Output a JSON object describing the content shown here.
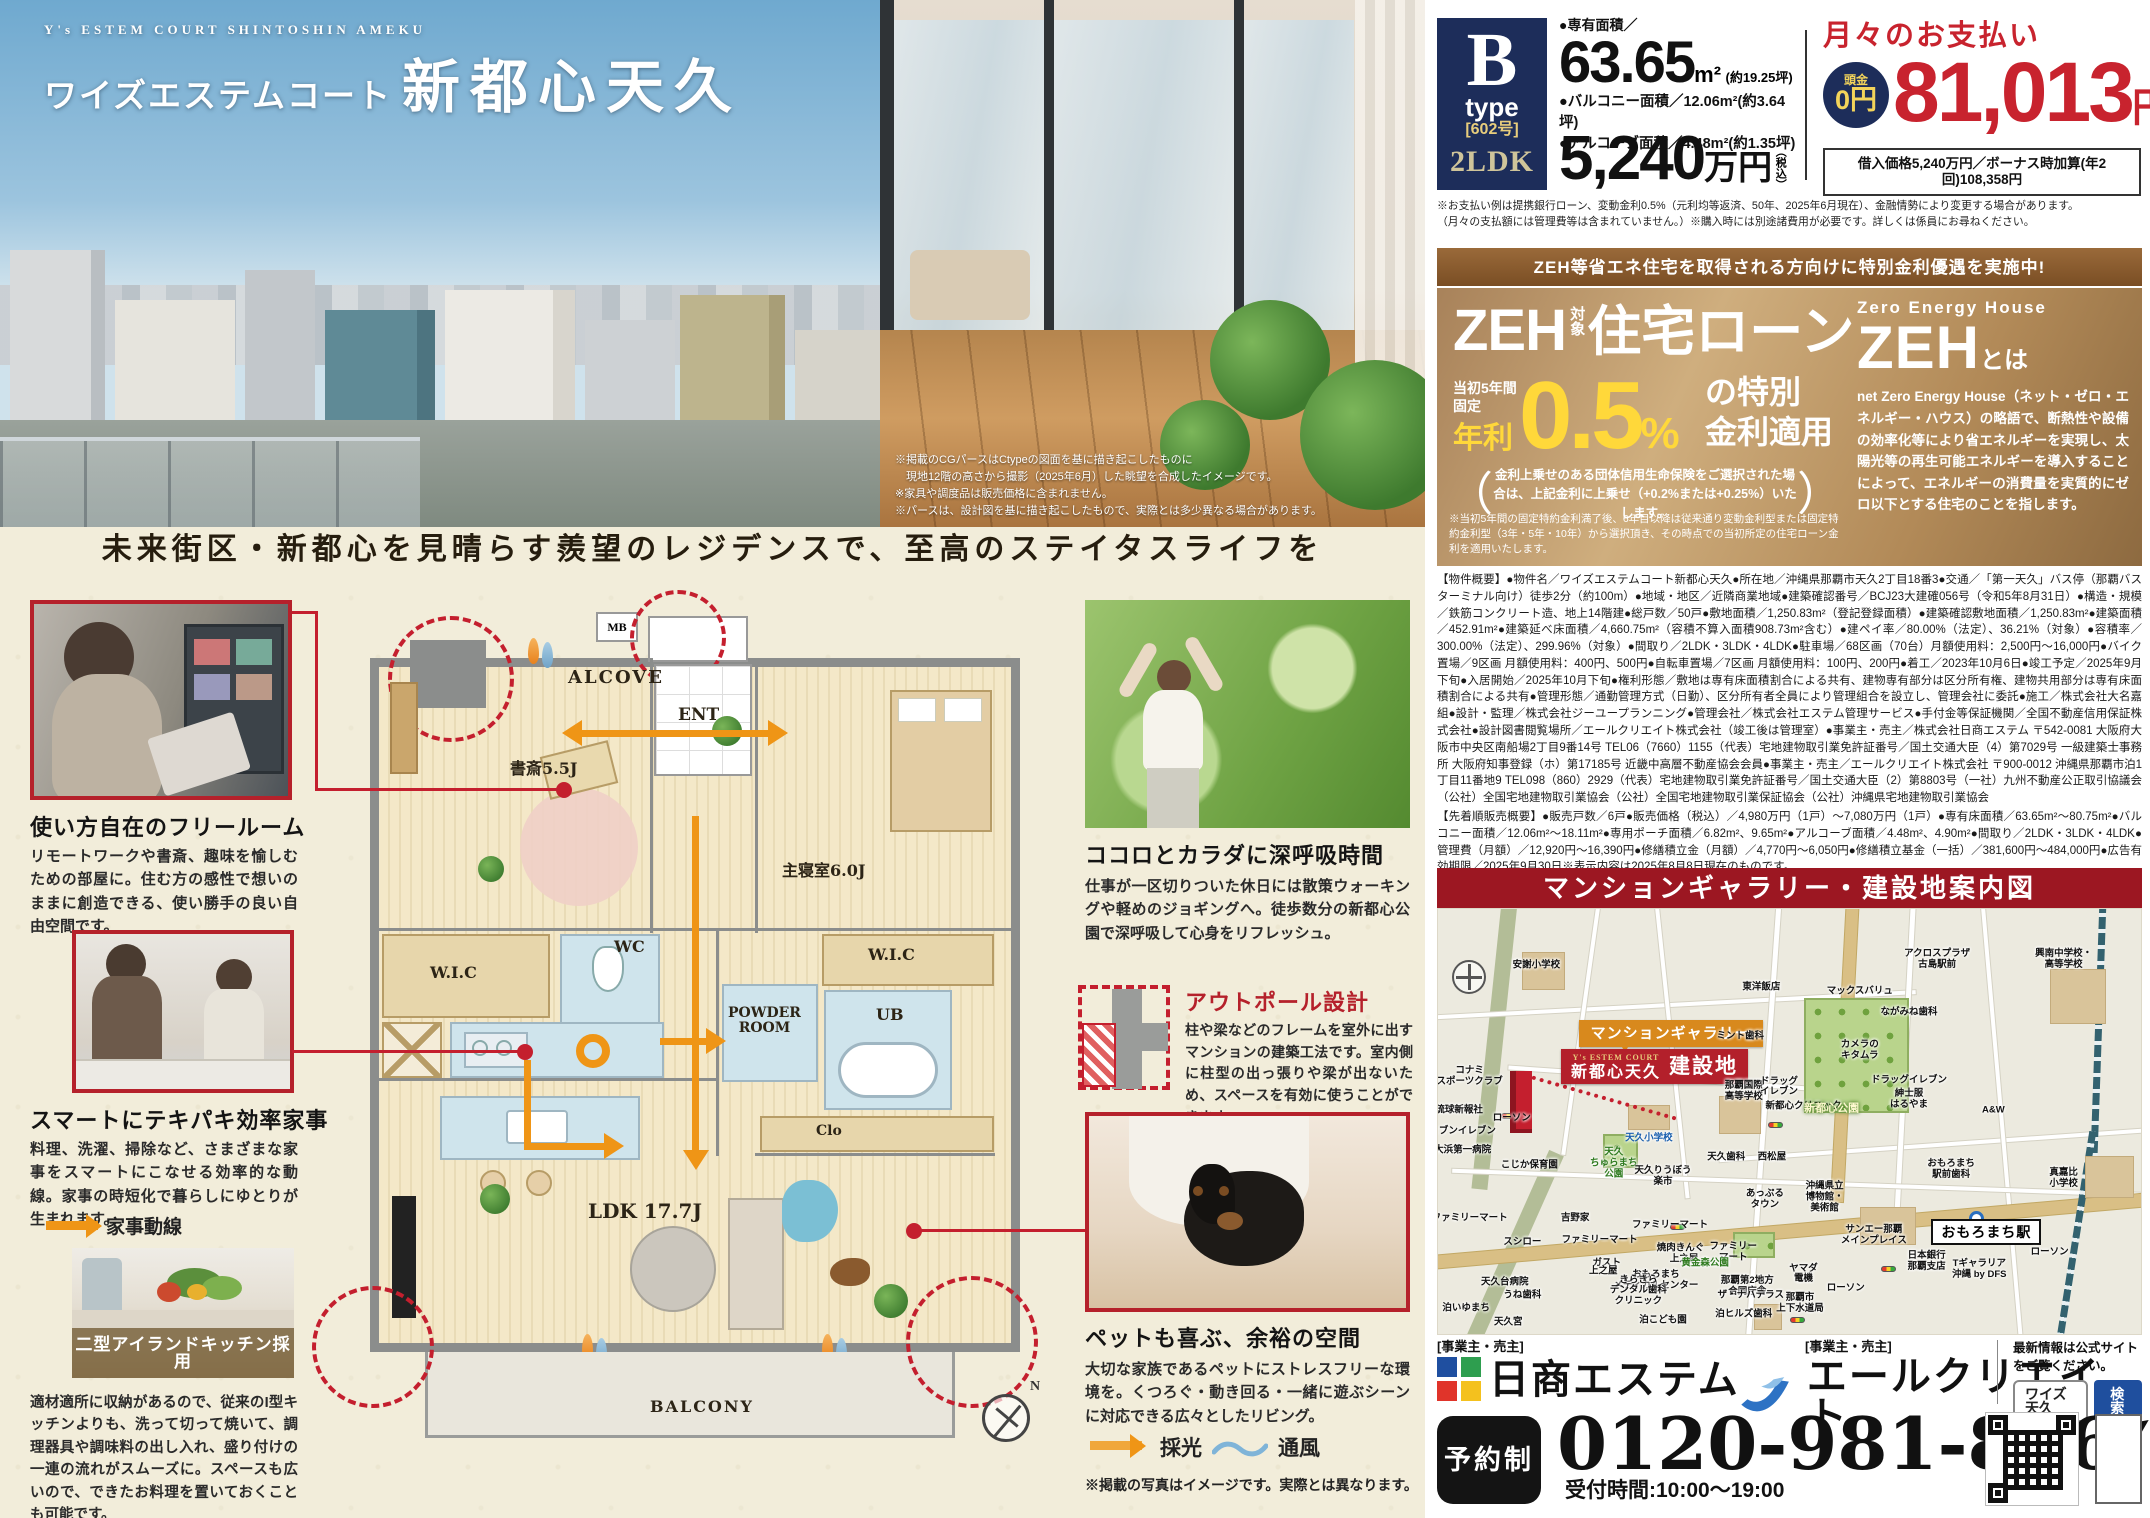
{
  "hero": {
    "en_title": "Y's ESTEM COURT SHINTOSHIN AMEKU",
    "brand": "ワイズエステムコート",
    "name": "新都心天久",
    "notes": "※掲載のCGパースはCtypeの図面を基に描き起こしたものに\n　現地12階の高さから撮影（2025年6月）した眺望を合成したイメージです。\n※家具や調度品は販売価格に含まれません。\n※パースは、設計図を基に描き起こしたもので、実際とは多少異なる場合があります。"
  },
  "tagline": "未来街区・新都心を見晴らす羨望のレジデンスで、至高のステイタスライフを",
  "features_left": [
    {
      "title": "使い方自在のフリールーム",
      "body": "リモートワークや書斎、趣味を愉しむための部屋に。住む方の感性で想いのままに創造できる、使い勝手の良い自由空間です。"
    },
    {
      "title": "スマートにテキパキ効率家事",
      "body": "料理、洗濯、掃除など、さまざまな家事をスマートにこなせる効率的な動線。家事の時短化で暮らしにゆとりが生まれます。",
      "legend": "家事動線"
    },
    {
      "title": "二型アイランドキッチン採用",
      "body": "適材適所に収納があるので、従来のI型キッチンよりも、洗って切って焼いて、調理器具や調味料の出し入れ、盛り付けの一連の流れがスムーズに。スペースも広いので、できたお料理を置いておくことも可能です。"
    }
  ],
  "features_right": [
    {
      "title": "ココロとカラダに深呼吸時間",
      "body": "仕事が一区切りついた休日には散策ウォーキングや軽めのジョギングへ。徒歩数分の新都心公園で深呼吸して心身をリフレッシュ。"
    },
    {
      "title": "アウトポール設計",
      "body": "柱や梁などのフレームを室外に出すマンションの建築工法です。室内側に柱型の出っ張りや梁が出ないため、スペースを有効に使うことができます。"
    },
    {
      "title": "ペットも喜ぶ、余裕の空間",
      "body": "大切な家族であるペットにストレスフリーな環境を。くつろぐ・動き回る・一緒に遊ぶシーンに対応できる広々としたリビング。"
    }
  ],
  "legend": {
    "saiko": "採光",
    "tsufu": "通風",
    "photo_note": "※掲載の写真はイメージです。実際とは異なります。"
  },
  "floorplan": {
    "alcove": "ALCOVE",
    "mb": "MB",
    "ent": "ENT",
    "study": "書斎5.5J",
    "bedroom": "主寝室6.0J",
    "wic1": "W.I.C",
    "wic2": "W.I.C",
    "wc": "WC",
    "powder": "POWDER\nROOM",
    "ub": "UB",
    "clo": "Clo",
    "ldk": "LDK 17.7J",
    "balcony": "BALCONY",
    "north": "N"
  },
  "price_panel": {
    "type_letter": "B",
    "type_word": "type",
    "unit_no": "[602号]",
    "layout": "2LDK",
    "area_label": "●専有面積／",
    "area_value": "63.65",
    "area_unit": "m²",
    "area_tsubo": "(約19.25坪)",
    "balcony_line": "●バルコニー面積／12.06m²(約3.64坪)",
    "alcove_line": "●アルコーブ面積／4.48m²(約1.35坪)",
    "price_value": "5,240",
    "price_unit": "万円",
    "price_tax": "（税込）",
    "monthly_title": "月々のお支払い",
    "down_label": "頭金",
    "down_value": "0円",
    "monthly_value": "81,013",
    "monthly_unit": "円",
    "loan_note": "借入価格5,240万円／ボーナス時加算(年2回)108,358円",
    "fine_print": "※お支払い例は提携銀行ローン、変動金利0.5%（元利均等返済、50年、2025年6月現在）、金融情勢により変更する場合があります。\n（月々の支払額には管理費等は含まれていません。）※購入時には別途諸費用が必要です。詳しくは係員にお尋ねください。"
  },
  "zeh": {
    "banner": "ZEH等省エネ住宅を取得される方向けに特別金利優遇を実施中!",
    "t_zeh": "ZEH",
    "t_taisho": "対象",
    "t_rest": "住宅ローン",
    "fixed": "当初5年間固定",
    "nenri": "年利",
    "rate": "0.5",
    "percent": "%",
    "rate_rest": "の特別\n金利適用",
    "paren_open": "（",
    "paren_close": "）",
    "paren": "金利上乗せのある団体信用生命保険をご選択された場合は、上記金利に上乗せ（+0.2%または+0.25%）いたします。",
    "note": "※当初5年間の固定特約金利満了後、6年目以降は従来通り変動金利型または固定特約金利型（3年・5年・10年）から選択頂き、その時点での当初所定の住宅ローン金利を適用いたします。",
    "right_en": "Zero Energy House",
    "right_zeh": "ZEH",
    "right_towa": "とは",
    "right_body": "net Zero Energy House（ネット・ゼロ・エネルギー・ハウス）の略語で、断熱性や設備の効率化等により省エネルギーを実現し、太陽光等の再生可能エネルギーを導入することによって、エネルギーの消費量を実質的にゼロ以下とする住宅のことを指します。"
  },
  "overview": {
    "p1": "【物件概要】●物件名／ワイズエステムコート新都心天久●所在地／沖縄県那覇市天久2丁目18番3●交通／「第一天久」バス停（那覇バスターミナル向け）徒歩2分（約100m）●地域・地区／近隣商業地域●建築確認番号／BCJ23大建確056号（令和5年8月31日）●構造・規模／鉄筋コンクリート造、地上14階建●総戸数／50戸●敷地面積／1,250.83m²（登記登録面積）●建築確認敷地面積／1,250.83m²●建築面積／452.91m²●建築延べ床面積／4,660.75m²（容積不算入面積908.73m²含む）●建ペイ率／80.00%（法定）、36.21%（対象）●容積率／300.00%（法定）、299.96%（対象）●間取り／2LDK・3LDK・4LDK●駐車場／68区画（70台）月額使用料：2,500円～16,000円●バイク置場／9区画 月額使用料：400円、500円●自転車置場／7区画 月額使用料：100円、200円●着工／2023年10月6日●竣工予定／2025年9月下旬●入居開始／2025年10月下旬●権利形態／敷地は専有床面積割合による共有、建物専有部分は区分所有権、建物共用部分は専有床面積割合による共有●管理形態／通勤管理方式（日勤）、区分所有者全員により管理組合を設立し、管理会社に委託●施工／株式会社大名嘉組●設計・監理／株式会社ジーユープランニング●管理会社／株式会社エステム管理サービス●手付金等保証機関／全国不動産信用保証株式会社●設計図書閲覧場所／エールクリエイト株式会社（竣工後は管理室）●事業主・売主／株式会社日商エステム 〒542-0081 大阪府大阪市中央区南船場2丁目9番14号 TEL06（7660）1155（代表）宅地建物取引業免許証番号／国土交通大臣（4）第7029号 一級建築士事務所 大阪府知事登録（ホ）第17185号 近畿中高層不動産協会会員●事業主・売主／エールクリエイト株式会社 〒900-0012 沖縄県那覇市泊1丁目11番地9 TEL098（860）2929（代表）宅地建物取引業免許証番号／国土交通大臣（2）第8803号（一社）九州不動産公正取引協議会（公社）全国宅地建物取引業協会（公社）全国宅地建物取引業保証協会（公社）沖縄県宅地建物取引業協会",
    "p2": "【先着順販売概要】●販売戸数／6戸●販売価格（税込）／4,980万円（1戸）～7,080万円（1戸）●専有床面積／63.65m²～80.75m²●バルコニー面積／12.06m²～18.11m²●専用ポーチ面積／6.82m²、9.65m²●アルコーブ面積／4.48m²、4.90m²●間取り／2LDK・3LDK・4LDK●管理費（月額）／12,920円～16,390円●修繕積立金（月額）／4,770円～6,050円●修繕積立基金（一括）／381,600円～484,000円●広告有効期限／2025年9月30日※表示内容は2025年8月8日現在のものです。"
  },
  "map": {
    "header": "マンションギャラリー・建設地案内図",
    "gallery_callout": "マンションギャラリー",
    "site_brand": "Y's ESTEM COURT",
    "site_name": "新都心天久",
    "site_label": "建設地",
    "station": "おもろまち駅",
    "labels": [
      {
        "t": "安謝小学校",
        "x": 14,
        "y": 13.5
      },
      {
        "t": "東洋飯店",
        "x": 46,
        "y": 18.5
      },
      {
        "t": "マックスバリュ",
        "x": 60,
        "y": 19.5
      },
      {
        "t": "アクロスプラザ\n古島駅前",
        "x": 71,
        "y": 12
      },
      {
        "t": "興南中学校・\n高等学校",
        "x": 89,
        "y": 12
      },
      {
        "t": "ながみね歯科",
        "x": 67,
        "y": 24.5
      },
      {
        "t": "ミント歯科",
        "x": 43,
        "y": 30
      },
      {
        "t": "カメラの\nキタムラ",
        "x": 60,
        "y": 33.5
      },
      {
        "t": "那覇国際\n高等学校",
        "x": 43.5,
        "y": 43
      },
      {
        "t": "新都心クリニック",
        "x": 52,
        "y": 46.5
      },
      {
        "t": "ドラッグ\nイレブン",
        "x": 48.5,
        "y": 42
      },
      {
        "t": "ドラッグイレブン",
        "x": 67,
        "y": 40.5
      },
      {
        "t": "A&W",
        "x": 79,
        "y": 47.5
      },
      {
        "t": "ローソン",
        "x": 10.5,
        "y": 49.5
      },
      {
        "t": "コナミ\nスポーツクラブ",
        "x": 4.5,
        "y": 39.5
      },
      {
        "t": "琉球新報社",
        "x": 3,
        "y": 47.5
      },
      {
        "t": "セブンイレブン",
        "x": 3.5,
        "y": 52.5
      },
      {
        "t": "大浜第一病院",
        "x": 3.5,
        "y": 57
      },
      {
        "t": "こじか保育園",
        "x": 13,
        "y": 60.5
      },
      {
        "t": "天久小学校",
        "x": 30,
        "y": 54,
        "c": "blue"
      },
      {
        "t": "天久\nちゅらまち\n公園",
        "x": 25,
        "y": 60,
        "c": "green"
      },
      {
        "t": "天久りうぼう\n楽市",
        "x": 32,
        "y": 63
      },
      {
        "t": "天久歯科",
        "x": 41,
        "y": 58.5
      },
      {
        "t": "西松屋",
        "x": 47.5,
        "y": 58.5
      },
      {
        "t": "新都心公園",
        "x": 56,
        "y": 47,
        "c": "parklabel"
      },
      {
        "t": "紳士服\nはるやま",
        "x": 67,
        "y": 45
      },
      {
        "t": "あっぷる\nタウン",
        "x": 46.5,
        "y": 68.5
      },
      {
        "t": "沖縄県立\n博物館・\n美術館",
        "x": 55,
        "y": 68
      },
      {
        "t": "サンエー那覇\nメインプレイス",
        "x": 62,
        "y": 77
      },
      {
        "t": "おもろまち\n駅前歯科",
        "x": 73,
        "y": 61.5
      },
      {
        "t": "真嘉比\n小学校",
        "x": 89,
        "y": 63.5
      },
      {
        "t": "日本銀行\n那覇支店",
        "x": 69.5,
        "y": 83
      },
      {
        "t": "Tギャラリア\n沖縄 by DFS",
        "x": 77,
        "y": 85
      },
      {
        "t": "ローソン",
        "x": 87,
        "y": 81
      },
      {
        "t": "ファミリーマート",
        "x": 4.5,
        "y": 73
      },
      {
        "t": "スシロー",
        "x": 12,
        "y": 78.5
      },
      {
        "t": "吉野家",
        "x": 19.5,
        "y": 73
      },
      {
        "t": "ファミリーマート",
        "x": 23,
        "y": 78
      },
      {
        "t": "ガスト",
        "x": 24,
        "y": 83.5
      },
      {
        "t": "天久台病院",
        "x": 9.5,
        "y": 88
      },
      {
        "t": "ファミリーマート",
        "x": 33,
        "y": 74.5
      },
      {
        "t": "焼肉きんぐ",
        "x": 34.5,
        "y": 80
      },
      {
        "t": "ファミリー\nマート",
        "x": 42,
        "y": 81
      },
      {
        "t": "おもろまち\nメディカルセンター",
        "x": 31,
        "y": 87.5
      },
      {
        "t": "那覇第2地方\n合同庁舎",
        "x": 44,
        "y": 89
      },
      {
        "t": "ヤマダ\n電機",
        "x": 52,
        "y": 86
      },
      {
        "t": "ローソン",
        "x": 58,
        "y": 89.5
      },
      {
        "t": "上之屋",
        "x": 23.5,
        "y": 85.5
      },
      {
        "t": "上之屋",
        "x": 35,
        "y": 82.5
      },
      {
        "t": "泊いゆまち",
        "x": 4,
        "y": 94
      },
      {
        "t": "天久宮",
        "x": 10,
        "y": 97.5
      },
      {
        "t": "うね歯科",
        "x": 12,
        "y": 91
      },
      {
        "t": "きらきら\nデンタル歯科\nクリニック",
        "x": 28.5,
        "y": 90
      },
      {
        "t": "泊こども園",
        "x": 32,
        "y": 97
      },
      {
        "t": "黄金森公園",
        "x": 38,
        "y": 83.5,
        "c": "green"
      },
      {
        "t": "ザ・ナハテラス",
        "x": 44.5,
        "y": 91
      },
      {
        "t": "泊ヒルズ歯科",
        "x": 43.5,
        "y": 95.5
      },
      {
        "t": "那覇市\n上下水道局",
        "x": 51.5,
        "y": 93
      }
    ]
  },
  "footer": {
    "role1": "[事業主・売主]",
    "company1": "日商エステム",
    "role2": "[事業主・売主]",
    "company2": "エールクリエイト",
    "site_note": "最新情報は公式サイトをご覧ください。",
    "search_term": "ワイズ天久",
    "search_btn": "検索",
    "reserve": "予約制",
    "phone": "0120-981-826",
    "hours": "受付時間:10:00～19:00"
  }
}
